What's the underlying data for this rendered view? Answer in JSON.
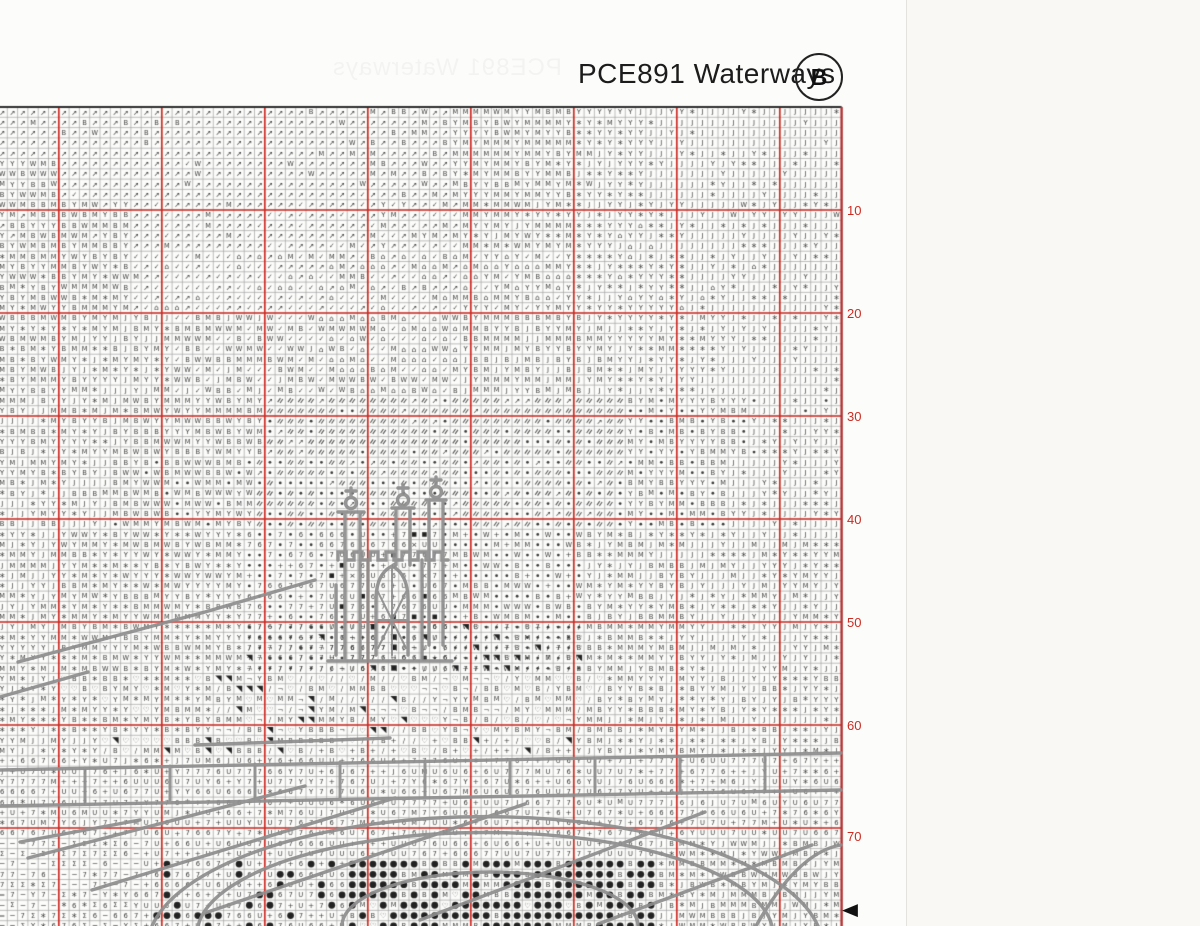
{
  "header": {
    "title": "PCE891 Waterways",
    "page_label": "B",
    "ghost_text": "PCE891 Waterways"
  },
  "grid": {
    "rows_visible": 80,
    "cols_visible": 82,
    "major_every": 10,
    "row_labels": [
      "10",
      "20",
      "30",
      "40",
      "50",
      "60",
      "70"
    ],
    "center_row_marker": "◀"
  },
  "colors": {
    "major_line": "#cf2b24",
    "minor_line": "#a2a2a2",
    "symbol": "#3c3c3c",
    "backstitch": "#8e8e8e",
    "edge_line": "#b03030",
    "top_edge": "#2f2f2f",
    "label_red": "#cc2b22"
  },
  "symbols": {
    "a": {
      "name": "arrow-ne",
      "glyph": "↗",
      "size": 7.2
    },
    "c": {
      "name": "check",
      "glyph": "✓",
      "size": 6.8
    },
    "p": {
      "name": "house-pot",
      "glyph": "⌂",
      "size": 7.6
    },
    "W": {
      "name": "letter-W",
      "glyph": "W",
      "size": 6.6
    },
    "B": {
      "name": "letter-B",
      "glyph": "B",
      "size": 6.8
    },
    "M": {
      "name": "letter-M",
      "glyph": "M",
      "size": 6.6
    },
    "Y": {
      "name": "letter-Y",
      "glyph": "Y",
      "size": 6.8
    },
    "J": {
      "name": "letter-J",
      "glyph": "J",
      "size": 6.8
    },
    "U": {
      "name": "letter-U",
      "glyph": "U",
      "size": 6.8
    },
    "6": {
      "name": "digit-6",
      "glyph": "6",
      "size": 6.8
    },
    "7": {
      "name": "digit-7",
      "glyph": "7",
      "size": 6.8
    },
    "+": {
      "name": "plus",
      "glyph": "+",
      "size": 7.4
    },
    "-": {
      "name": "minus",
      "glyph": "−",
      "size": 7.4
    },
    "=": {
      "name": "equals",
      "glyph": "=",
      "size": 7.0
    },
    "S": {
      "name": "sigma",
      "glyph": "Σ",
      "size": 6.6
    },
    "*": {
      "name": "sparkle",
      "glyph": "*",
      "size": 10,
      "dy": 2.6
    },
    "h": {
      "name": "heart-outline",
      "glyph": "♡",
      "size": 7.4
    },
    "x": {
      "name": "cross-x",
      "glyph": "×",
      "size": 7.6
    },
    "n": {
      "name": "corner-glyph",
      "glyph": "¬",
      "size": 6.8
    },
    "/": {
      "name": "slash",
      "glyph": "∕",
      "size": 7.0
    },
    "s": {
      "name": "chain-doubleslash",
      "draw": "chain"
    },
    "d": {
      "name": "dot-small",
      "draw": "dotS"
    },
    "O": {
      "name": "dot-filled-large",
      "draw": "dotL"
    },
    "q": {
      "name": "square-filled",
      "draw": "sq"
    },
    "t": {
      "name": "triangle-filled",
      "draw": "tri"
    }
  },
  "regions": [
    {
      "r": [
        0,
        4
      ],
      "c": [
        0,
        35
      ],
      "mix": "a:95,W:2,B:2,M:1"
    },
    {
      "r": [
        0,
        4
      ],
      "c": [
        36,
        43
      ],
      "mix": "a:60,B:14,W:10,M:16"
    },
    {
      "r": [
        0,
        4
      ],
      "c": [
        44,
        55
      ],
      "mix": "M:42,Y:38,B:12,W:8"
    },
    {
      "r": [
        0,
        4
      ],
      "c": [
        56,
        62
      ],
      "mix": "Y:52,*:30,M:10,J:8"
    },
    {
      "r": [
        0,
        4
      ],
      "c": [
        63,
        81
      ],
      "mix": "J:84,*:8,Y:8"
    },
    {
      "r": [
        5,
        8
      ],
      "c": [
        0,
        5
      ],
      "mix": "W:30,B:30,M:20,Y:20"
    },
    {
      "r": [
        5,
        8
      ],
      "c": [
        6,
        35
      ],
      "mix": "a:90,W:5,c:5"
    },
    {
      "r": [
        5,
        8
      ],
      "c": [
        36,
        43
      ],
      "mix": "a:55,B:20,M:15,W:10"
    },
    {
      "r": [
        5,
        8
      ],
      "c": [
        44,
        55
      ],
      "mix": "M:40,Y:40,*:10,B:10"
    },
    {
      "r": [
        5,
        8
      ],
      "c": [
        56,
        62
      ],
      "mix": "Y:45,*:35,J:15,W:5"
    },
    {
      "r": [
        5,
        8
      ],
      "c": [
        63,
        81
      ],
      "mix": "J:80,*:12,Y:8"
    },
    {
      "r": [
        9,
        13
      ],
      "c": [
        0,
        12
      ],
      "mix": "Y:30,M:30,B:20,W:15,a:5"
    },
    {
      "r": [
        9,
        13
      ],
      "c": [
        13,
        35
      ],
      "mix": "a:80,c:15,M:5"
    },
    {
      "r": [
        9,
        13
      ],
      "c": [
        36,
        44
      ],
      "mix": "a:40,c:25,M:20,Y:15"
    },
    {
      "r": [
        9,
        13
      ],
      "c": [
        45,
        55
      ],
      "mix": "M:35,Y:35,*:15,J:10,W:5"
    },
    {
      "r": [
        9,
        13
      ],
      "c": [
        56,
        64
      ],
      "mix": "Y:40,*:30,J:25,p:5"
    },
    {
      "r": [
        9,
        13
      ],
      "c": [
        65,
        81
      ],
      "mix": "J:70,*:15,Y:10,W:5"
    },
    {
      "r": [
        14,
        19
      ],
      "c": [
        0,
        12
      ],
      "mix": "Y:30,M:25,B:20,W:15,*:10"
    },
    {
      "r": [
        14,
        19
      ],
      "c": [
        13,
        30
      ],
      "mix": "c:60,a:25,p:10,M:5"
    },
    {
      "r": [
        14,
        19
      ],
      "c": [
        31,
        44
      ],
      "mix": "c:45,p:25,a:15,M:10,B:5"
    },
    {
      "r": [
        14,
        19
      ],
      "c": [
        45,
        55
      ],
      "mix": "p:30,M:25,Y:25,c:10,B:10"
    },
    {
      "r": [
        14,
        19
      ],
      "c": [
        56,
        66
      ],
      "mix": "Y:40,*:35,J:15,p:10"
    },
    {
      "r": [
        14,
        19
      ],
      "c": [
        67,
        81
      ],
      "mix": "J:60,*:20,Y:15,p:5"
    },
    {
      "r": [
        20,
        27
      ],
      "c": [
        0,
        5
      ],
      "mix": "B:25,Y:25,M:25,*:15,W:10"
    },
    {
      "r": [
        20,
        27
      ],
      "c": [
        6,
        16
      ],
      "mix": "Y:30,M:25,J:20,*:15,B:10"
    },
    {
      "r": [
        20,
        27
      ],
      "c": [
        17,
        30
      ],
      "mix": "c:35,W:20,B:20,M:15,J:10"
    },
    {
      "r": [
        20,
        27
      ],
      "c": [
        31,
        44
      ],
      "mix": "p:30,c:25,B:15,W:15,M:15"
    },
    {
      "r": [
        20,
        27
      ],
      "c": [
        45,
        58
      ],
      "mix": "M:35,Y:30,B:20,J:15"
    },
    {
      "r": [
        20,
        27
      ],
      "c": [
        59,
        70
      ],
      "mix": "Y:35,*:30,J:25,M:10"
    },
    {
      "r": [
        20,
        27
      ],
      "c": [
        71,
        81
      ],
      "mix": "J:75,*:15,Y:10"
    },
    {
      "r": [
        28,
        33
      ],
      "c": [
        0,
        12
      ],
      "mix": "Y:25,M:20,J:20,B:20,*:15"
    },
    {
      "r": [
        28,
        33
      ],
      "c": [
        13,
        25
      ],
      "mix": "B:30,M:25,W:20,Y:25"
    },
    {
      "r": [
        28,
        33
      ],
      "c": [
        26,
        60
      ],
      "mix": "s:75,d:15,a:10"
    },
    {
      "r": [
        28,
        33
      ],
      "c": [
        61,
        72
      ],
      "mix": "M:30,Y:30,d:20,B:20"
    },
    {
      "r": [
        28,
        33
      ],
      "c": [
        73,
        81
      ],
      "mix": "J:55,*:20,Y:15,d:10"
    },
    {
      "r": [
        34,
        40
      ],
      "c": [
        0,
        10
      ],
      "mix": "J:30,Y:25,*:20,M:15,B:10"
    },
    {
      "r": [
        34,
        40
      ],
      "c": [
        11,
        24
      ],
      "mix": "B:30,M:25,W:20,d:15,Y:10"
    },
    {
      "r": [
        34,
        40
      ],
      "c": [
        25,
        60
      ],
      "mix": "s:50,d:40,a:10"
    },
    {
      "r": [
        34,
        40
      ],
      "c": [
        61,
        70
      ],
      "mix": "d:30,B:25,M:25,Y:20"
    },
    {
      "r": [
        34,
        40
      ],
      "c": [
        71,
        81
      ],
      "mix": "J:65,*:20,Y:15"
    },
    {
      "r": [
        41,
        54
      ],
      "c": [
        0,
        5
      ],
      "mix": "Y:30,M:25,J:25,*:20"
    },
    {
      "r": [
        41,
        54
      ],
      "c": [
        6,
        23
      ],
      "mix": "Y:30,M:25,*:20,W:15,B:10"
    },
    {
      "r": [
        41,
        54
      ],
      "c": [
        24,
        31
      ],
      "mix": "d:40,7:30,6:20,+:10"
    },
    {
      "r": [
        41,
        54
      ],
      "c": [
        32,
        43
      ],
      "mix": "7:24,6:24,U:20,+:10,d:10,q:6,x:6"
    },
    {
      "r": [
        41,
        54
      ],
      "c": [
        44,
        56
      ],
      "mix": "d:50,W:14,B:14,M:14,+:8"
    },
    {
      "r": [
        41,
        54
      ],
      "c": [
        57,
        66
      ],
      "mix": "M:25,B:20,Y:25,*:15,J:15"
    },
    {
      "r": [
        41,
        54
      ],
      "c": [
        67,
        81
      ],
      "mix": "J:50,Y:20,*:20,M:10"
    },
    {
      "r": [
        50,
        54
      ],
      "c": [
        24,
        43
      ],
      "mix": "7:20,6:20,/:20,n:15,d:15,t:10"
    },
    {
      "r": [
        50,
        54
      ],
      "c": [
        44,
        56
      ],
      "mix": "/:30,n:20,t:15,h:10,d:15,7:10"
    },
    {
      "r": [
        55,
        60
      ],
      "c": [
        0,
        5
      ],
      "mix": "Y:30,M:25,*:25,J:20"
    },
    {
      "r": [
        55,
        60
      ],
      "c": [
        6,
        20
      ],
      "mix": "Y:25,M:20,B:20,*:20,h:15"
    },
    {
      "r": [
        55,
        60
      ],
      "c": [
        21,
        43
      ],
      "mix": "h:22,/:15,n:12,B:16,M:15,Y:10,t:10"
    },
    {
      "r": [
        55,
        60
      ],
      "c": [
        44,
        58
      ],
      "mix": "B:22,M:22,h:18,Y:13,/:15,n:10"
    },
    {
      "r": [
        55,
        60
      ],
      "c": [
        59,
        70
      ],
      "mix": "Y:30,*:25,J:20,B:15,M:10"
    },
    {
      "r": [
        55,
        60
      ],
      "c": [
        71,
        81
      ],
      "mix": "J:45,*:25,Y:20,B:10"
    },
    {
      "r": [
        61,
        62
      ],
      "c": [
        0,
        9
      ],
      "mix": "Y:30,M:20,J:25,*:25"
    },
    {
      "r": [
        61,
        62
      ],
      "c": [
        10,
        30
      ],
      "mix": "h:40,t:25,B:15,M:10,/:10"
    },
    {
      "r": [
        61,
        62
      ],
      "c": [
        31,
        55
      ],
      "mix": "h:20,t:15,/:15,+:30,B:20"
    },
    {
      "r": [
        61,
        62
      ],
      "c": [
        56,
        81
      ],
      "mix": "Y:25,*:25,J:25,B:15,M:10"
    },
    {
      "r": [
        63,
        70
      ],
      "c": [
        0,
        81
      ],
      "mix": "6:25,7:25,U:20,+:14,Y:5,*:5,J:3,M:3"
    },
    {
      "r": [
        71,
        72
      ],
      "c": [
        0,
        2
      ],
      "mix": "-:40,S:30,=:15,7:15"
    },
    {
      "r": [
        71,
        72
      ],
      "c": [
        3,
        13
      ],
      "mix": "S:25,-:20,7:20,6:15,Y:10,*:10"
    },
    {
      "r": [
        71,
        72
      ],
      "c": [
        14,
        63
      ],
      "mix": "+:25,U:25,6:25,7:25"
    },
    {
      "r": [
        71,
        72
      ],
      "c": [
        64,
        81
      ],
      "mix": "B:20,M:20,*:20,Y:15,W:10,J:15"
    },
    {
      "r": [
        73,
        79
      ],
      "c": [
        0,
        2
      ],
      "mix": "-:40,S:30,=:15,7:15"
    },
    {
      "r": [
        73,
        79
      ],
      "c": [
        3,
        13
      ],
      "mix": "S:25,-:20,7:20,6:15,Y:10,*:10"
    },
    {
      "r": [
        73,
        79
      ],
      "c": [
        14,
        33
      ],
      "mix": "6:22,7:22,U:18,+:18,O:20"
    },
    {
      "r": [
        73,
        79
      ],
      "c": [
        34,
        63
      ],
      "mix": "O:72,B:14,M:9,h:5"
    },
    {
      "r": [
        73,
        79
      ],
      "c": [
        64,
        81
      ],
      "mix": "B:25,M:25,*:15,Y:10,W:10,J:15"
    }
  ]
}
